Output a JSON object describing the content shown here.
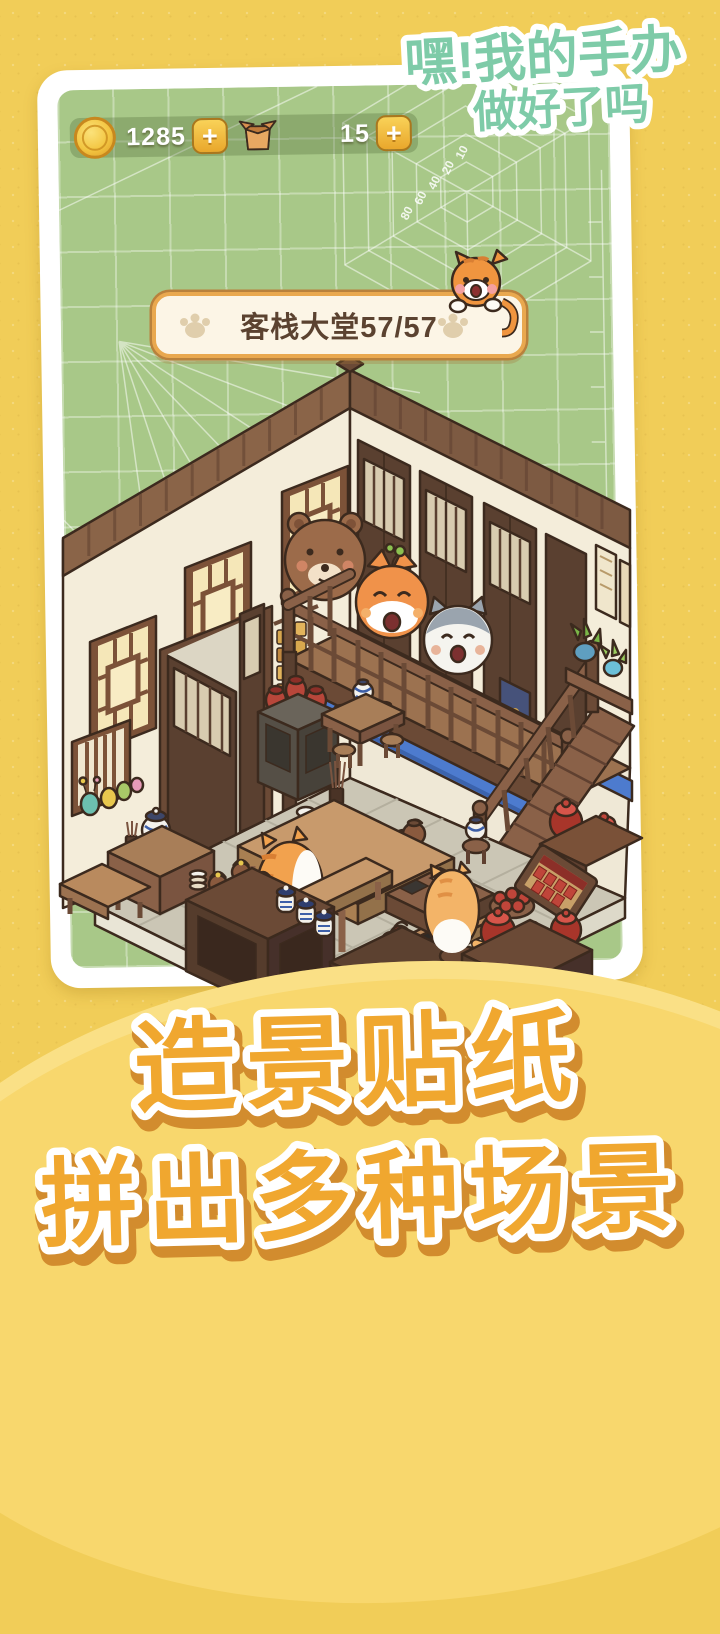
{
  "title": {
    "line1": "嘿!我的手办",
    "line2": "做好了吗"
  },
  "hud": {
    "coin_value": "1285",
    "box_value": "15",
    "plus_label": "+"
  },
  "banner": {
    "label": "客栈大堂57/57"
  },
  "mat": {
    "scale_labels": [
      "80",
      "60",
      "40",
      "20",
      "10"
    ]
  },
  "scene": {
    "name": "inn-lobby-diorama",
    "figures": [
      "brown-bear",
      "shiba-inu",
      "husky",
      "orange-tabby-cat",
      "cream-cat",
      "peeking-cat"
    ]
  },
  "footer": {
    "line1": "造景贴纸",
    "line2": "拼出多种场景"
  },
  "colors": {
    "background": "#f1cd58",
    "hill": "#f8d76d",
    "mat": "#a8c888",
    "title": "#7ecba8",
    "footer_text": "#f0a72f",
    "banner_border": "#e9a84f",
    "blue_beam": "#4d7bce"
  }
}
